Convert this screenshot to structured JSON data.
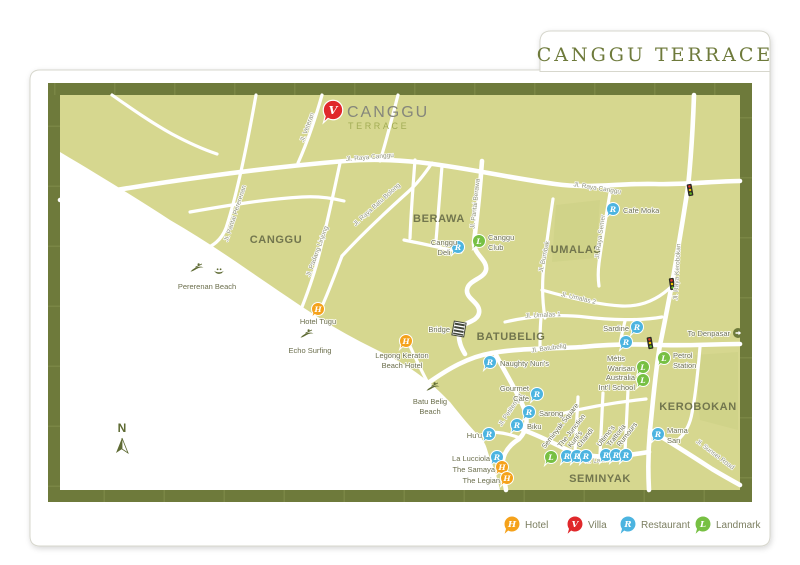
{
  "title": "CANGGU TERRACE",
  "legend": {
    "items": [
      {
        "letter": "H",
        "label": "Hotel",
        "color": "#f5a21b"
      },
      {
        "letter": "V",
        "label": "Villa",
        "color": "#e0282b"
      },
      {
        "letter": "R",
        "label": "Restaurant",
        "color": "#4cb4e0"
      },
      {
        "letter": "L",
        "label": "Landmark",
        "color": "#77c043"
      }
    ]
  },
  "map": {
    "compass": "N",
    "bridge": "Bridge",
    "to_denpasar": "To Denpasar",
    "land_color": "#d6d78f",
    "frame_color": "#6e7a3b",
    "villa": {
      "letter": "V",
      "name_line1": "CANGGU",
      "name_line2": "TERRACE"
    },
    "areas": {
      "canggu": "CANGGU",
      "berawa": "BERAWA",
      "umalas": "UMALAS",
      "batubelig": "BATUBELIG",
      "kerobokan": "KEROBOKAN",
      "seminyak": "SEMINYAK"
    },
    "streets": {
      "raya_canggu_w": "Jl. Raya Canggu",
      "raya_canggu_e": "Jl. Raya Canggu",
      "pantai_pererenan": "Jl. Pantai Pererenan",
      "padang_linjong": "Jl. Padang Linjong",
      "raya_batu_bolong": "Jl. Raya Batu Bolong",
      "veteran": "Jl. Veteran",
      "pantai_berawa": "Jl. Pantai Berawa",
      "bumbak": "Jl. Bumbak",
      "raya_semer": "Jl. Raya Semer",
      "raya_kerobokan": "Jl. Raya Kerobokan",
      "umalas_2": "Jl. Umalas 2",
      "umalas_1": "Jl. Umalas 1",
      "batubelig": "Jl. Batubelig",
      "petitenget": "Jl. Petitenget",
      "laksmana": "Jl. Laksmana",
      "sunset_road": "Jl. Sunset Road"
    },
    "beaches": {
      "pererenan": "Pererenan Beach",
      "echo_surfing": "Echo Surfing",
      "batu_belig": [
        "Batu Belig",
        "Beach"
      ]
    },
    "pois": {
      "hotel_tugu": {
        "letter": "H",
        "lines": [
          "Hotel Tugu"
        ]
      },
      "legong_keraton": {
        "letter": "H",
        "lines": [
          "Legong Keraton",
          "Beach Hotel"
        ]
      },
      "the_samaya": {
        "letter": "H",
        "lines": [
          "The Samaya"
        ]
      },
      "the_legian": {
        "letter": "H",
        "lines": [
          "The Legian"
        ]
      },
      "canggu_deli": {
        "letter": "R",
        "lines": [
          "Canggu",
          "Deli"
        ]
      },
      "canggu_club": {
        "letter": "L",
        "lines": [
          "Canggu",
          "Club"
        ]
      },
      "cafe_moka": {
        "letter": "R",
        "lines": [
          "Cafe Moka"
        ]
      },
      "sardine": {
        "letter": "R",
        "lines": [
          "Sardine"
        ]
      },
      "metis": {
        "letter": "R",
        "lines": [
          "Métis"
        ]
      },
      "naughty_nuris": {
        "letter": "R",
        "lines": [
          "Naughty Nuri's"
        ]
      },
      "gourmet_cafe": {
        "letter": "R",
        "lines": [
          "Gourmet",
          "Cafe"
        ]
      },
      "sarong": {
        "letter": "R",
        "lines": [
          "Sarong"
        ]
      },
      "biku": {
        "letter": "R",
        "lines": [
          "Biku"
        ]
      },
      "huu": {
        "letter": "R",
        "lines": [
          "Hu'u"
        ]
      },
      "la_lucciola": {
        "letter": "R",
        "lines": [
          "La Lucciola"
        ]
      },
      "warisan": {
        "letter": "L",
        "lines": [
          "Warisan"
        ]
      },
      "australia_school": {
        "letter": "L",
        "lines": [
          "Australia",
          "Int'l School"
        ]
      },
      "petrol_station": {
        "letter": "L",
        "lines": [
          "Petrol",
          "Station"
        ]
      },
      "mama_san": {
        "letter": "R",
        "lines": [
          "Mama",
          "San"
        ]
      },
      "seminyak_square": {
        "letter": "L",
        "lines": [
          "Seminyak Square"
        ]
      },
      "the_junction": {
        "letter": "R",
        "lines": [
          "The Junction"
        ]
      },
      "kunis": {
        "letter": "R",
        "lines": [
          "Kuni's"
        ]
      },
      "chandi": {
        "letter": "R",
        "lines": [
          "Chandi"
        ]
      },
      "ultimos": {
        "letter": "R",
        "lines": [
          "Ultimo's"
        ]
      },
      "trattoria": {
        "letter": "R",
        "lines": [
          "Trattoria"
        ]
      },
      "rumours": {
        "letter": "R",
        "lines": [
          "Rumours"
        ]
      }
    }
  }
}
